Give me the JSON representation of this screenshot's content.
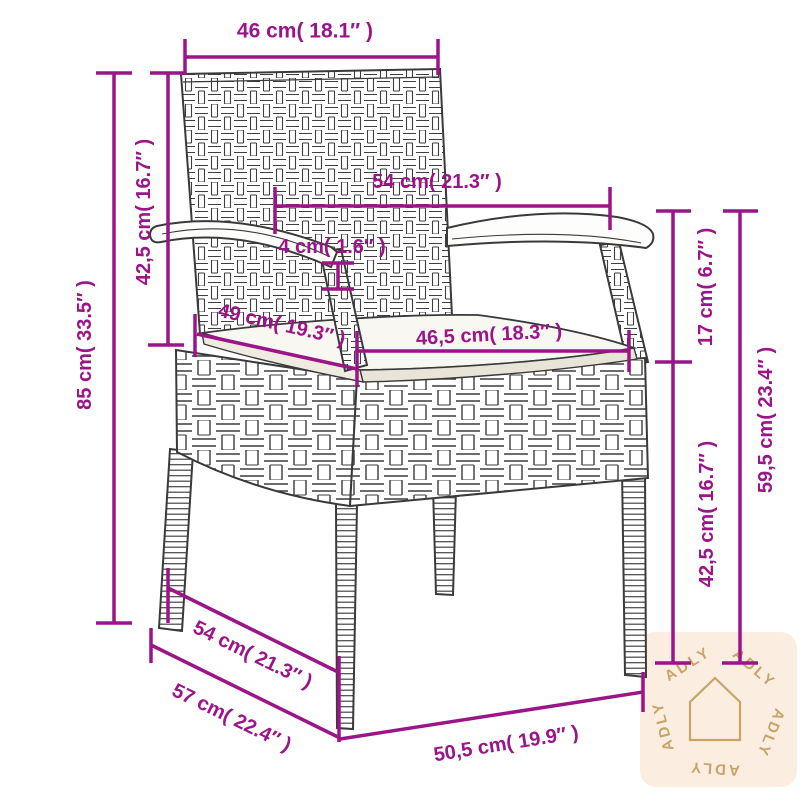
{
  "diagram": {
    "type": "product-dimension-diagram",
    "unit_system": "cm / inches"
  },
  "colors": {
    "dimension_accent": "#9b1488",
    "chair_line": "#3a3a3a",
    "cushion_fill": "#f9f7f1",
    "watermark_bg": "#fbeee1",
    "watermark_fg": "#c8a469",
    "background": "#ffffff"
  },
  "dimensions": {
    "back_width": {
      "label": "46 cm( 18.1″ )",
      "cm": 46,
      "in": 18.1
    },
    "backrest_height": {
      "label": "42,5 cm( 16.7″ )",
      "cm": 42.5,
      "in": 16.7
    },
    "total_height": {
      "label": "85 cm( 33.5″ )",
      "cm": 85,
      "in": 33.5
    },
    "armrest_span": {
      "label": "54 cm( 21.3″ )",
      "cm": 54,
      "in": 21.3
    },
    "armrest_thickness": {
      "label": "4 cm( 1.6″ )",
      "cm": 4,
      "in": 1.6
    },
    "seat_depth": {
      "label": "49 cm( 19.3″ )",
      "cm": 49,
      "in": 19.3
    },
    "seat_width": {
      "label": "46,5 cm( 18.3″ )",
      "cm": 46.5,
      "in": 18.3
    },
    "armrest_above_seat": {
      "label": "17 cm( 6.7″ )",
      "cm": 17,
      "in": 6.7
    },
    "seat_height": {
      "label": "42,5 cm( 16.7″ )",
      "cm": 42.5,
      "in": 16.7
    },
    "armrest_height": {
      "label": "59,5 cm( 23.4″ )",
      "cm": 59.5,
      "in": 23.4
    },
    "base_depth": {
      "label": "54 cm( 21.3″ )",
      "cm": 54,
      "in": 21.3
    },
    "total_depth": {
      "label": "57 cm( 22.4″ )",
      "cm": 57,
      "in": 22.4
    },
    "base_width": {
      "label": "50,5 cm( 19.9″ )",
      "cm": 50.5,
      "in": 19.9
    }
  },
  "watermark": {
    "brand": "ADLY"
  }
}
